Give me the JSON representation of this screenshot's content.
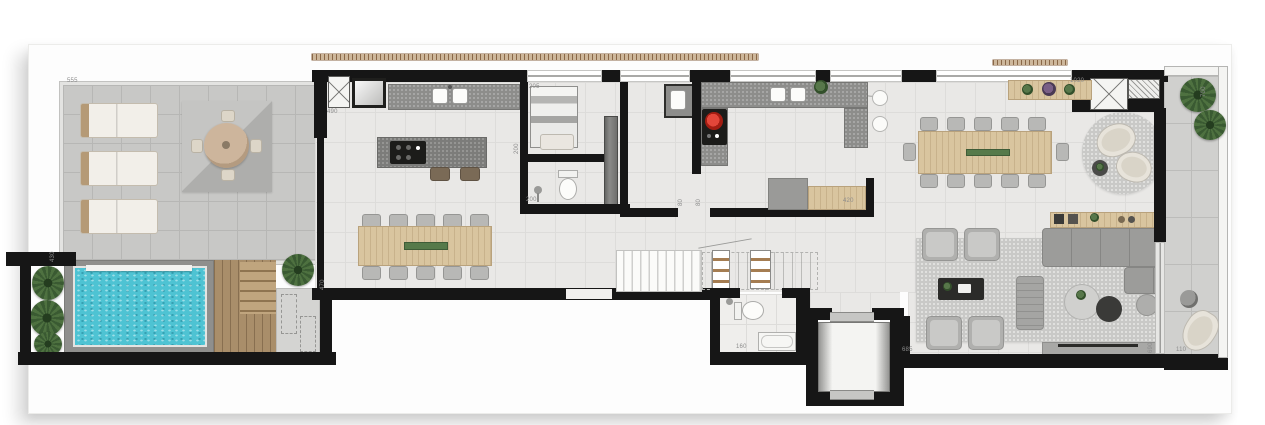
{
  "plan": {
    "type": "penthouse-floor-plan",
    "labels": [
      {
        "id": "terrace-width",
        "text": "555"
      },
      {
        "id": "gourmet-width",
        "text": "490"
      },
      {
        "id": "pool-side-left",
        "text": "430"
      },
      {
        "id": "pool-side-right",
        "text": "470"
      },
      {
        "id": "laundry-width",
        "text": "205"
      },
      {
        "id": "laundry-depth",
        "text": "200"
      },
      {
        "id": "bath1-width",
        "text": "200"
      },
      {
        "id": "hall-door-a",
        "text": "80"
      },
      {
        "id": "hall-door-b",
        "text": "80"
      },
      {
        "id": "kitchen-sideboard",
        "text": "420"
      },
      {
        "id": "dining-width",
        "text": "1020"
      },
      {
        "id": "balcony-depth",
        "text": "700"
      },
      {
        "id": "living-width",
        "text": "685"
      },
      {
        "id": "living-depth",
        "text": "690"
      },
      {
        "id": "balcony-end",
        "text": "110"
      },
      {
        "id": "bath2-width",
        "text": "160"
      }
    ],
    "palette": {
      "wall": "#161616",
      "floor": "#e9e8e6",
      "terrace_floor": "#c8c8c6",
      "pool_water": "#4ec3d3",
      "deck_wood": "#a98e6a",
      "furniture_wood": "#d9c59f",
      "plant_green": "#41613a",
      "cooktop_red": "#cf2b20",
      "label_gray": "#8c8c8c"
    }
  }
}
